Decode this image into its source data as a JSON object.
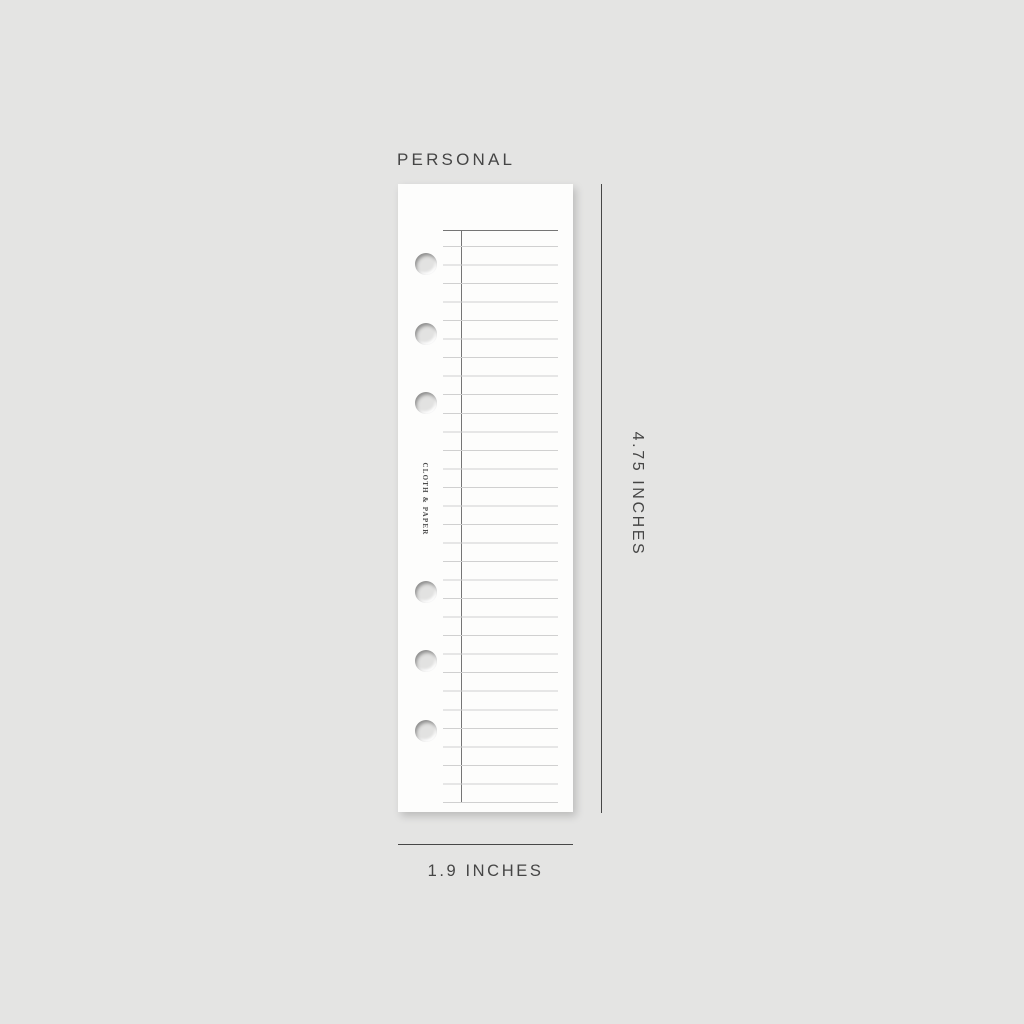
{
  "product_view": {
    "size_label": "PERSONAL",
    "brand_text": "CLOTH & PAPER",
    "dimensions": {
      "height_label": "4.75 INCHES",
      "width_label": "1.9 INCHES"
    },
    "punch_hole_count": 6
  },
  "colors": {
    "background": "#e4e4e3",
    "page": "#fdfdfc",
    "ruling_light": "#d0d0d0",
    "ruling_dark": "#757575",
    "dimension_line": "#474747",
    "label_text": "#454545"
  }
}
